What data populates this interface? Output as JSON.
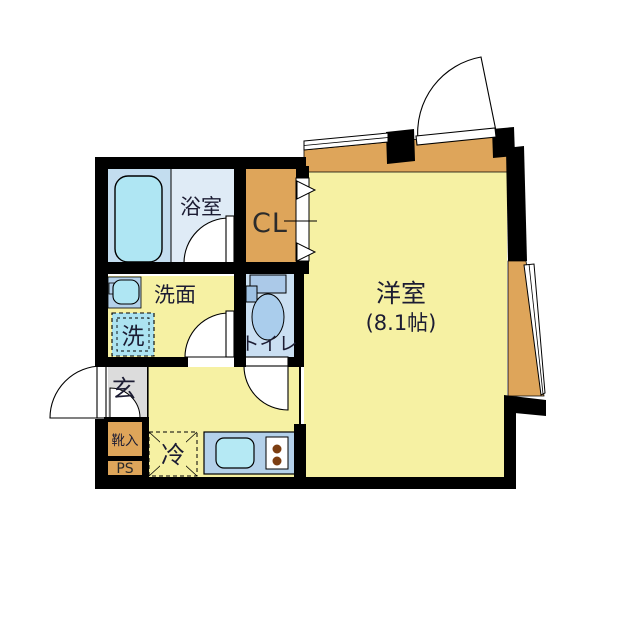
{
  "title": "apartment-floor-plan",
  "rooms": {
    "bathroom": {
      "label": "浴室"
    },
    "closet": {
      "label": "CL"
    },
    "washroom": {
      "label": "洗面"
    },
    "washer": {
      "label": "洗"
    },
    "toilet": {
      "label": "トイレ"
    },
    "entrance": {
      "label": "玄"
    },
    "shoe_cabinet": {
      "label": "靴入"
    },
    "pipe_space": {
      "label": "PS"
    },
    "refrigerator": {
      "label": "冷"
    },
    "main_room": {
      "label": "洋室",
      "size": "(8.1帖)"
    }
  },
  "colors": {
    "wall": "#000000",
    "room_yellow": "#F6F1A3",
    "balcony_orange": "#DEA55A",
    "bath_blue": "#C3DDEF",
    "bath_light": "#DFEBF6",
    "fixture_cyan": "#AFE6F3",
    "counter_blue": "#B4D1EA",
    "toilet_floor": "#CADFF2",
    "toilet_fixture": "#AACDEC",
    "entry_gray": "#DCDCDC",
    "burner_brown": "#7C3E12",
    "text_dark": "#1C1C33"
  }
}
